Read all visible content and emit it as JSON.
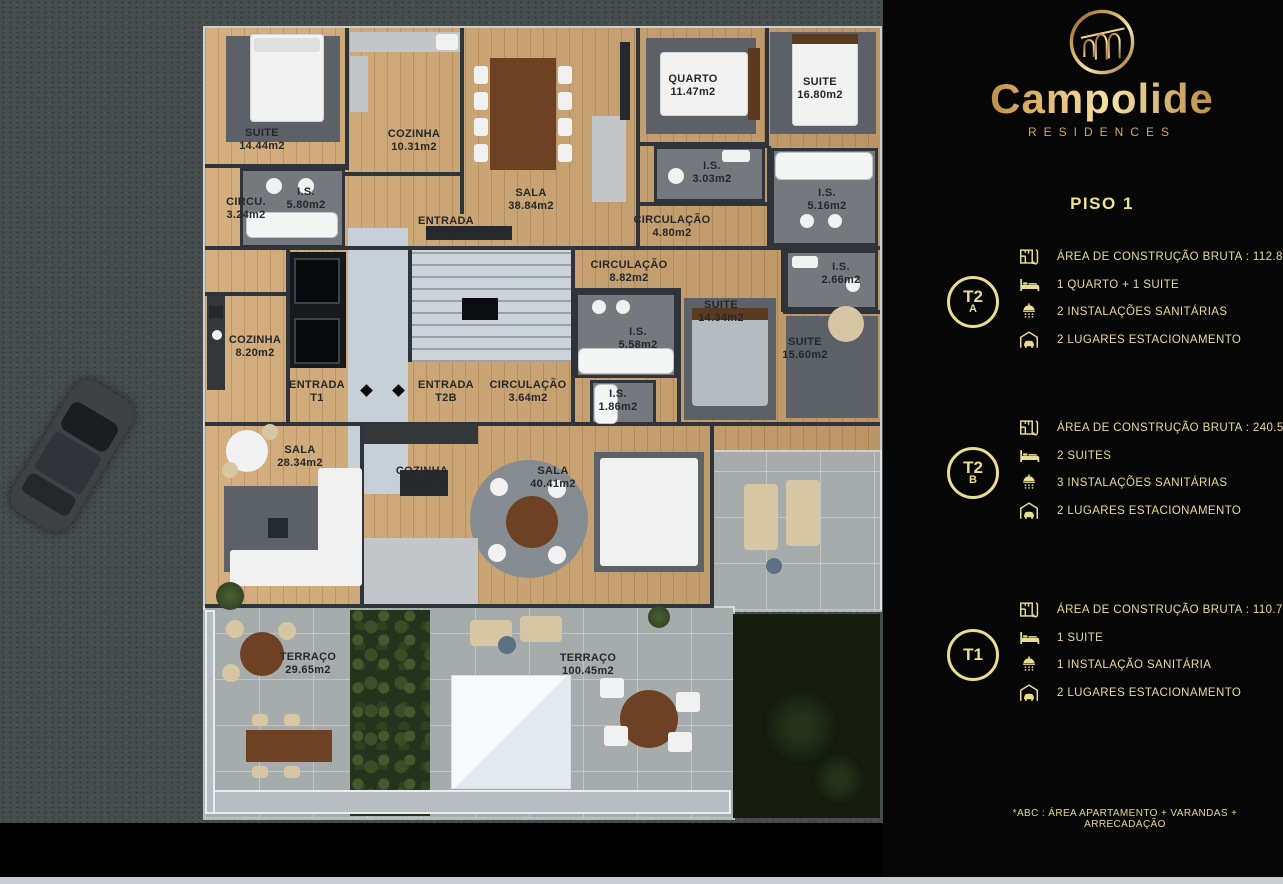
{
  "brand": {
    "name": "Campolide",
    "tagline": "RESIDENCES",
    "logo": "aqueduct-arches-logo"
  },
  "panel": {
    "floor_title": "PISO 1",
    "footnote": "*ABC :  ÁREA APARTAMENTO + VARANDAS + ARRECADAÇÃO"
  },
  "colors": {
    "gold_text": "#e9dd93",
    "gold_bright": "#f4e1a6",
    "gold_dark": "#8a5f2c",
    "panel_bg": "#060606",
    "asphalt": "#474d4d",
    "wall": "#2e3439",
    "wood_floor": "#cfa671",
    "terrace_tile": "#a6acab",
    "label_text": "#26272b"
  },
  "units": [
    {
      "badge": "T2",
      "badge_sub": "A",
      "specs": [
        {
          "icon": "floorplan-icon",
          "text": "ÁREA DE CONSTRUÇÃO BRUTA :  112.85 м2*"
        },
        {
          "icon": "bed-icon",
          "text": "1 QUARTO + 1 SUITE"
        },
        {
          "icon": "shower-icon",
          "text": "2 INSTALAÇÕES SANITÁRIAS"
        },
        {
          "icon": "garage-icon",
          "text": "2 LUGARES ESTACIONAMENTO"
        }
      ]
    },
    {
      "badge": "T2",
      "badge_sub": "B",
      "specs": [
        {
          "icon": "floorplan-icon",
          "text": "ÁREA DE CONSTRUÇÃO BRUTA :  240.55 м2*"
        },
        {
          "icon": "bed-icon",
          "text": "2 SUITES"
        },
        {
          "icon": "shower-icon",
          "text": "3 INSTALAÇÕES SANITÁRIAS"
        },
        {
          "icon": "garage-icon",
          "text": "2 LUGARES ESTACIONAMENTO"
        }
      ]
    },
    {
      "badge": "T1",
      "badge_sub": "",
      "specs": [
        {
          "icon": "floorplan-icon",
          "text": "ÁREA DE CONSTRUÇÃO BRUTA :  110.70м2*"
        },
        {
          "icon": "bed-icon",
          "text": "1 SUITE"
        },
        {
          "icon": "shower-icon",
          "text": "1 INSTALAÇÃO SANITÁRIA"
        },
        {
          "icon": "garage-icon",
          "text": "2 LUGARES ESTACIONAMENTO"
        }
      ]
    }
  ],
  "floorplan": {
    "floor": "PISO 1",
    "rooms": [
      {
        "name": "SUITE",
        "detail": "14.44m2",
        "x": 262,
        "y": 140
      },
      {
        "name": "COZINHA",
        "detail": "10.31m2",
        "x": 414,
        "y": 141
      },
      {
        "name": "SALA",
        "detail": "38.84m2",
        "x": 531,
        "y": 200
      },
      {
        "name": "QUARTO",
        "detail": "11.47m2",
        "x": 693,
        "y": 86
      },
      {
        "name": "SUITE",
        "detail": "16.80m2",
        "x": 820,
        "y": 89
      },
      {
        "name": "I.S.",
        "detail": "3.03m2",
        "x": 712,
        "y": 173
      },
      {
        "name": "CIRCULAÇÃO",
        "detail": "4.80m2",
        "x": 672,
        "y": 227
      },
      {
        "name": "I.S.",
        "detail": "5.16m2",
        "x": 827,
        "y": 200
      },
      {
        "name": "I.S.",
        "detail": "5.80m2",
        "x": 306,
        "y": 199
      },
      {
        "name": "CIRCU.",
        "detail": "3.24m2",
        "x": 246,
        "y": 209
      },
      {
        "name": "ENTRADA",
        "detail": "T2A",
        "x": 446,
        "y": 228
      },
      {
        "name": "CIRCULAÇÃO",
        "detail": "8.82m2",
        "x": 629,
        "y": 272
      },
      {
        "name": "I.S.",
        "detail": "2.66m2",
        "x": 841,
        "y": 274
      },
      {
        "name": "SUITE",
        "detail": "14.34m2",
        "x": 721,
        "y": 312
      },
      {
        "name": "I.S.",
        "detail": "5.58m2",
        "x": 638,
        "y": 339
      },
      {
        "name": "SUITE",
        "detail": "15.60m2",
        "x": 805,
        "y": 349
      },
      {
        "name": "COZINHA",
        "detail": "8.20m2",
        "x": 255,
        "y": 347
      },
      {
        "name": "ENTRADA",
        "detail": "T1",
        "x": 317,
        "y": 392
      },
      {
        "name": "ENTRADA",
        "detail": "T2B",
        "x": 446,
        "y": 392
      },
      {
        "name": "CIRCULAÇÃO",
        "detail": "3.64m2",
        "x": 528,
        "y": 392
      },
      {
        "name": "I.S.",
        "detail": "1.86m2",
        "x": 618,
        "y": 401
      },
      {
        "name": "SALA",
        "detail": "28.34m2",
        "x": 300,
        "y": 457
      },
      {
        "name": "COZINHA",
        "detail": "12.20m2",
        "x": 422,
        "y": 478
      },
      {
        "name": "SALA",
        "detail": "40.41m2",
        "x": 553,
        "y": 478
      },
      {
        "name": "TERRAÇO",
        "detail": "29.65m2",
        "x": 308,
        "y": 664
      },
      {
        "name": "TERRAÇO",
        "detail": "100.45m2",
        "x": 588,
        "y": 665
      }
    ]
  }
}
